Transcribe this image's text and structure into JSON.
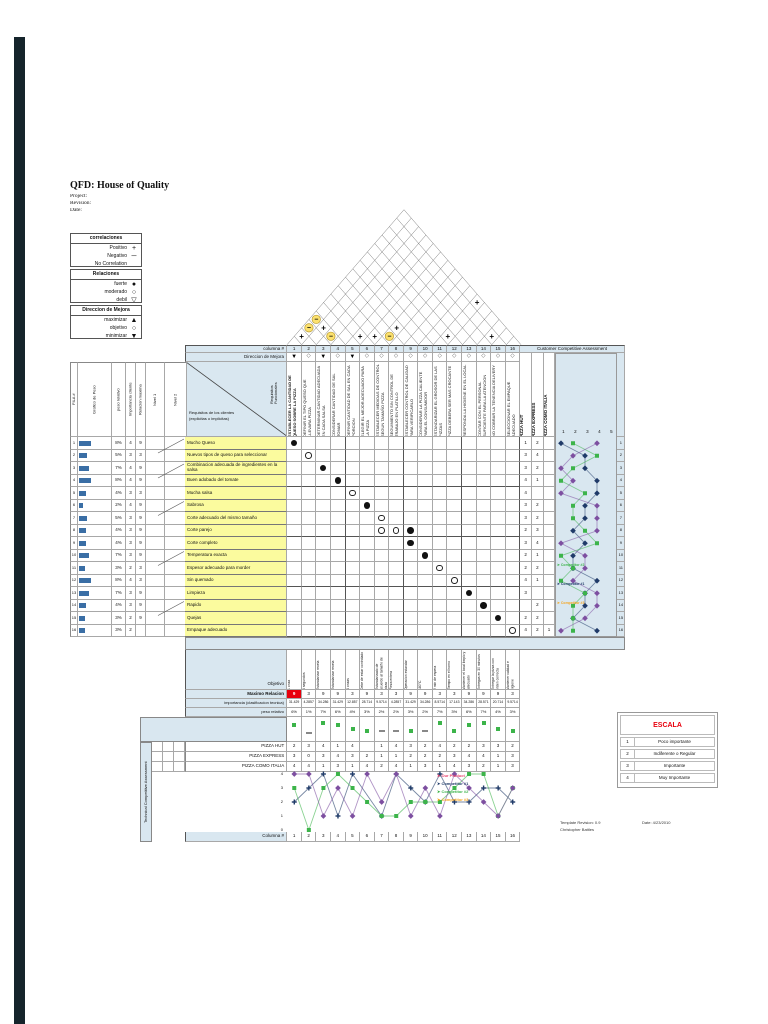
{
  "page": {
    "title": "QFD: House of Quality",
    "project_label": "Project:",
    "revision_label": "Revision:",
    "date_label": "Date:"
  },
  "legends": [
    {
      "title": "correlaciones",
      "items": [
        {
          "label": "Positivo",
          "symbol": "+"
        },
        {
          "label": "Negativo",
          "symbol": "─"
        },
        {
          "label": "No Correlation",
          "symbol": ""
        }
      ]
    },
    {
      "title": "Relaciones",
      "items": [
        {
          "label": "fuerte",
          "symbol": "●"
        },
        {
          "label": "moderado",
          "symbol": "○"
        },
        {
          "label": "debil",
          "symbol": "▽"
        }
      ]
    },
    {
      "title": "Direccion de Mejora",
      "items": [
        {
          "label": "maximizar",
          "symbol": "▲"
        },
        {
          "label": "objetivo",
          "symbol": "○"
        },
        {
          "label": "minimizar",
          "symbol": "▼"
        }
      ]
    }
  ],
  "matrix": {
    "columna_label": "columna #",
    "direccion_label": "Direccion de Mejora",
    "cca_label": "Customer Competitive Assessment",
    "requisitos_top": "Requisitos Funcionales",
    "requisitos_left": "Requisitos de los clientes (explicitas o implicitas)",
    "left_headers": [
      "FILA #",
      "Grafico de Peso",
      "peso relativo",
      "Importancia cliente",
      "Relacion maxima",
      "Nivel 1",
      "Nivel 2"
    ],
    "pizza_columns": [
      "PIZZA HUT",
      "PIZZA EXPRESS",
      "PIZZA COMO ITALIA"
    ],
    "scale_ticks": [
      "1",
      "2",
      "3",
      "4",
      "5"
    ],
    "columns": [
      {
        "num": "1",
        "direction": "▼",
        "bold": true,
        "title": "ESTABLECER LA CANTIDAD DE QUESO SOBRE LA PIZZA"
      },
      {
        "num": "2",
        "direction": "◇",
        "bold": false,
        "title": "DEFINIR EL TIPO QUESO QUE LLEVARA PIZZA"
      },
      {
        "num": "3",
        "direction": "▼",
        "bold": false,
        "title": "DETERMINAR CANTIDAD ADECUADA EN CADA SALSA"
      },
      {
        "num": "4",
        "direction": "◇",
        "bold": false,
        "title": "CONSIDERAR CANTIDAD DE SAL TOMAR"
      },
      {
        "num": "5",
        "direction": "▼",
        "bold": false,
        "title": "DEFINIR CANTIDAD DE SAL EN CADA PORCION"
      },
      {
        "num": "6",
        "direction": "◇",
        "bold": false,
        "title": "ELEGIR EL MEJOR ADECUADO PARA LA PIZZA"
      },
      {
        "num": "7",
        "direction": "◇",
        "bold": false,
        "title": "ESTABLECER MEDIDAS DE CONTROL SEGUN TAMAÑO PIZZA"
      },
      {
        "num": "8",
        "direction": "◇",
        "bold": false,
        "title": "SEGUIMIENTO SIN CONTROL DE TRABAJO EN PLATILLO"
      },
      {
        "num": "9",
        "direction": "◇",
        "bold": false,
        "title": "ESTABLECER CONTROL DE CALIDAD PARA VERIFICARLO"
      },
      {
        "num": "10",
        "direction": "◇",
        "bold": false,
        "title": "CONSIDERAR LA PIZZA CALIENTE PARA EL CONSUMIDOR"
      },
      {
        "num": "11",
        "direction": "◇",
        "bold": false,
        "title": "ESTANDARIZAR EL GROSOR DE LAS PIZZAS"
      },
      {
        "num": "12",
        "direction": "◇",
        "bold": false,
        "title": "PIZZA DEBERA SER MAS CROCANTE"
      },
      {
        "num": "13",
        "direction": "◇",
        "bold": false,
        "title": "RESPONDA LA HIGIENE EN EL LOCAL"
      },
      {
        "num": "14",
        "direction": "◇",
        "bold": false,
        "title": "CONTAR CON EL PERSONAL SUFICIENTE PARA LA ATENCION"
      },
      {
        "num": "15",
        "direction": "◇",
        "bold": false,
        "title": "NO COBRAR LA TENENCIA DELIVERY"
      },
      {
        "num": "16",
        "direction": "◇",
        "bold": false,
        "title": "SELECCIONAR EL EMPAQUE ADECUADO"
      }
    ],
    "rows": [
      {
        "fila": "1",
        "peso": "8%",
        "importancia": "4",
        "relacion": "9",
        "label": "Mucho Queso",
        "hut": "1",
        "express": "2",
        "italia": ""
      },
      {
        "fila": "2",
        "peso": "5%",
        "importancia": "3",
        "relacion": "3",
        "label": "Nuevos tipos de queso para seleccionar",
        "hut": "3",
        "express": "4",
        "italia": ""
      },
      {
        "fila": "3",
        "peso": "7%",
        "importancia": "4",
        "relacion": "9",
        "label": "Combinacion adecuada de ingredientes en la salsa",
        "hut": "3",
        "express": "2",
        "italia": ""
      },
      {
        "fila": "4",
        "peso": "8%",
        "importancia": "4",
        "relacion": "9",
        "label": "Buen adobado del tomate",
        "hut": "4",
        "express": "1",
        "italia": ""
      },
      {
        "fila": "5",
        "peso": "4%",
        "importancia": "3",
        "relacion": "3",
        "label": "Mucha salsa",
        "hut": "4",
        "express": "",
        "italia": ""
      },
      {
        "fila": "6",
        "peso": "2%",
        "importancia": "4",
        "relacion": "9",
        "label": "Sabrosa",
        "hut": "3",
        "express": "2",
        "italia": ""
      },
      {
        "fila": "7",
        "peso": "5%",
        "importancia": "3",
        "relacion": "9",
        "label": "Corte adecuado del mismo tamaño",
        "hut": "3",
        "express": "2",
        "italia": ""
      },
      {
        "fila": "8",
        "peso": "4%",
        "importancia": "3",
        "relacion": "9",
        "label": "Corte parejo",
        "hut": "2",
        "express": "3",
        "italia": ""
      },
      {
        "fila": "9",
        "peso": "4%",
        "importancia": "3",
        "relacion": "9",
        "label": "Corte completo",
        "hut": "3",
        "express": "4",
        "italia": ""
      },
      {
        "fila": "10",
        "peso": "7%",
        "importancia": "3",
        "relacion": "9",
        "label": "Temperatura exacta",
        "hut": "2",
        "express": "1",
        "italia": ""
      },
      {
        "fila": "11",
        "peso": "3%",
        "importancia": "2",
        "relacion": "3",
        "label": "Espesor adecuado para morder",
        "hut": "2",
        "express": "2",
        "italia": ""
      },
      {
        "fila": "12",
        "peso": "8%",
        "importancia": "4",
        "relacion": "3",
        "label": "Sin quemado",
        "hut": "4",
        "express": "1",
        "italia": ""
      },
      {
        "fila": "13",
        "peso": "7%",
        "importancia": "3",
        "relacion": "9",
        "label": "Limpieza",
        "hut": "3",
        "express": "",
        "italia": ""
      },
      {
        "fila": "14",
        "peso": "4%",
        "importancia": "3",
        "relacion": "9",
        "label": "Rapido",
        "hut": "",
        "express": "2",
        "italia": ""
      },
      {
        "fila": "15",
        "peso": "3%",
        "importancia": "2",
        "relacion": "9",
        "label": "Quejas",
        "hut": "2",
        "express": "2",
        "italia": ""
      },
      {
        "fila": "16",
        "peso": "3%",
        "importancia": "2",
        "relacion": "",
        "label": "Empaque adecuado",
        "hut": "4",
        "express": "2",
        "italia": "1"
      }
    ],
    "relationships": [
      {
        "row": 1,
        "col": 1,
        "type": "strong"
      },
      {
        "row": 2,
        "col": 2,
        "type": "moderate"
      },
      {
        "row": 3,
        "col": 3,
        "type": "strong"
      },
      {
        "row": 4,
        "col": 4,
        "type": "strong"
      },
      {
        "row": 5,
        "col": 5,
        "type": "moderate"
      },
      {
        "row": 6,
        "col": 6,
        "type": "strong"
      },
      {
        "row": 7,
        "col": 7,
        "type": "moderate"
      },
      {
        "row": 8,
        "col": 7,
        "type": "moderate"
      },
      {
        "row": 8,
        "col": 8,
        "type": "moderate"
      },
      {
        "row": 8,
        "col": 9,
        "type": "strong"
      },
      {
        "row": 9,
        "col": 9,
        "type": "strong"
      },
      {
        "row": 10,
        "col": 10,
        "type": "strong"
      },
      {
        "row": 11,
        "col": 11,
        "type": "moderate"
      },
      {
        "row": 12,
        "col": 12,
        "type": "moderate"
      },
      {
        "row": 13,
        "col": 13,
        "type": "strong"
      },
      {
        "row": 14,
        "col": 14,
        "type": "strong"
      },
      {
        "row": 15,
        "col": 15,
        "type": "strong"
      },
      {
        "row": 16,
        "col": 16,
        "type": "moderate"
      }
    ],
    "roof_marks": [
      {
        "i": 1,
        "j": 2,
        "sign": "+"
      },
      {
        "i": 1,
        "j": 3,
        "sign": "−"
      },
      {
        "i": 1,
        "j": 4,
        "sign": "−"
      },
      {
        "i": 2,
        "j": 4,
        "sign": "+"
      },
      {
        "i": 3,
        "j": 4,
        "sign": "−"
      },
      {
        "i": 5,
        "j": 6,
        "sign": "+"
      },
      {
        "i": 6,
        "j": 7,
        "sign": "+"
      },
      {
        "i": 7,
        "j": 8,
        "sign": "−"
      },
      {
        "i": 7,
        "j": 9,
        "sign": "+"
      },
      {
        "i": 11,
        "j": 12,
        "sign": "+"
      },
      {
        "i": 11,
        "j": 16,
        "sign": "+"
      },
      {
        "i": 14,
        "j": 15,
        "sign": "+"
      }
    ]
  },
  "bottom": {
    "objetivo_label": "Objetivo",
    "objetivo": [
      "1 onza",
      "6 segundos",
      "Estandarizar receta",
      "Estandarizar receta",
      "3 onzas",
      "Debe de estar controlado",
      "Estandarizado de acuerdo al tamaño de pizza",
      "Pieza entera",
      "Operacion estandar",
      "180°C",
      "2 min de espera",
      "Tiempo en el horno",
      "Mantener el local limpio y adecuado",
      "Entregas en 30 minutos",
      "Entregar la pizza con orden correcta",
      "Mantener calidad e higiene"
    ],
    "maximo_label": "Maximo Relacion",
    "maximo": [
      "9",
      "3",
      "9",
      "9",
      "3",
      "9",
      "3",
      "3",
      "9",
      "9",
      "3",
      "3",
      "9",
      "9",
      "9",
      "3"
    ],
    "importancia_label": "importancia (clasificacion tecnica)",
    "importancia": [
      "31.429",
      "4.2857",
      "34.286",
      "31.429",
      "12.857",
      "28.714",
      "9.5714",
      "4.2857",
      "31.429",
      "34.286",
      "8.5714",
      "17.143",
      "34.286",
      "28.571",
      "20.714",
      "9.5714"
    ],
    "peso_label": "peso relativo",
    "peso": [
      "6%",
      "1%",
      "7%",
      "6%",
      "4%",
      "3%",
      "2%",
      "2%",
      "3%",
      "2%",
      "7%",
      "3%",
      "6%",
      "7%",
      "4%",
      "3%"
    ],
    "tca_label": "Technical Competitive Assessment",
    "competitor_rows": [
      {
        "label": "PIZZA HUT",
        "values": [
          "2",
          "3",
          "4",
          "1",
          "4",
          "",
          "1",
          "4",
          "3",
          "2",
          "4",
          "2",
          "2",
          "3",
          "3",
          "2"
        ]
      },
      {
        "label": "PIZZA EXPRESS",
        "values": [
          "3",
          "0",
          "3",
          "4",
          "3",
          "2",
          "1",
          "1",
          "2",
          "2",
          "2",
          "3",
          "4",
          "4",
          "1",
          "3"
        ]
      },
      {
        "label": "PIZZA COMO ITALIA",
        "values": [
          "4",
          "4",
          "1",
          "3",
          "1",
          "4",
          "2",
          "4",
          "1",
          "3",
          "1",
          "4",
          "3",
          "2",
          "1",
          "3"
        ]
      }
    ],
    "columna_label": "Columna #",
    "columns": [
      "1",
      "2",
      "3",
      "4",
      "5",
      "6",
      "7",
      "8",
      "9",
      "10",
      "11",
      "12",
      "13",
      "14",
      "15",
      "16"
    ]
  },
  "charts": {
    "customer": {
      "type": "line",
      "x_range": [
        1,
        5
      ],
      "series": [
        {
          "name": "PIZZA HUT",
          "color": "#1f3a68",
          "marker": "diamond",
          "values": [
            1,
            3,
            3,
            4,
            4,
            3,
            3,
            2,
            3,
            2,
            2,
            4,
            3,
            3,
            2,
            4
          ]
        },
        {
          "name": "PIZZA EXPRESS",
          "color": "#3cb44a",
          "marker": "square",
          "values": [
            2,
            4,
            2,
            1,
            3,
            2,
            2,
            3,
            4,
            1,
            2,
            1,
            3,
            2,
            2,
            2
          ]
        },
        {
          "name": "PIZZA COMO ITALIA",
          "color": "#7d4fa0",
          "marker": "diamond",
          "values": [
            4,
            2,
            1,
            2,
            1,
            4,
            4,
            4,
            1,
            3,
            3,
            2,
            4,
            4,
            3,
            1
          ]
        }
      ],
      "legend": [
        {
          "label": "Competitor #2",
          "color": "#3cb44a"
        },
        {
          "label": "Competitor #1",
          "color": "#1f3a68"
        },
        {
          "label": "Competitor #3",
          "color": "#f5a623"
        }
      ]
    },
    "technical": {
      "type": "line",
      "y_ticks": [
        "4",
        "3",
        "2",
        "1",
        "0"
      ],
      "y_range": [
        0,
        4
      ],
      "series": [
        {
          "name": "PIZZA HUT",
          "color": "#1f3a68",
          "marker": "plus",
          "values": [
            2,
            3,
            4,
            1,
            4,
            null,
            1,
            4,
            3,
            2,
            4,
            2,
            2,
            3,
            3,
            2
          ]
        },
        {
          "name": "PIZZA EXPRESS",
          "color": "#3cb44a",
          "marker": "square",
          "values": [
            3,
            0,
            3,
            4,
            3,
            2,
            1,
            1,
            2,
            2,
            2,
            3,
            4,
            4,
            1,
            3
          ]
        },
        {
          "name": "PIZZA COMO ITALIA",
          "color": "#7d4fa0",
          "marker": "diamond",
          "values": [
            4,
            4,
            1,
            3,
            1,
            4,
            2,
            4,
            1,
            3,
            1,
            4,
            3,
            2,
            1,
            3
          ]
        }
      ],
      "legend": [
        {
          "label": "Our Product",
          "color": "#e8436e"
        },
        {
          "label": "Competitor #1",
          "color": "#1f3a68"
        },
        {
          "label": "Competitor #2",
          "color": "#3cb44a"
        },
        {
          "label": "Competitor #3",
          "color": "#f5a623"
        }
      ]
    }
  },
  "escala": {
    "title": "ESCALA",
    "rows": [
      {
        "value": "1",
        "label": "Poco importante"
      },
      {
        "value": "2",
        "label": "Indiferente o Regular"
      },
      {
        "value": "3",
        "label": "Importante"
      },
      {
        "value": "4",
        "label": "Muy Importante"
      }
    ]
  },
  "footer": {
    "revision": "Template Revision: 0.9",
    "author": "Christopher Battles",
    "date": "Date: 4/23/2010"
  },
  "colors": {
    "panel_blue": "#d9e7f0",
    "row_yellow": "#fbfb9e",
    "alert_red": "#e8000d",
    "roof_yellow": "#fce16e",
    "navy": "#1f3a68",
    "green": "#3cb44a",
    "purple": "#7d4fa0",
    "orange": "#f5a623",
    "bar_blue": "#3a6ea5"
  }
}
